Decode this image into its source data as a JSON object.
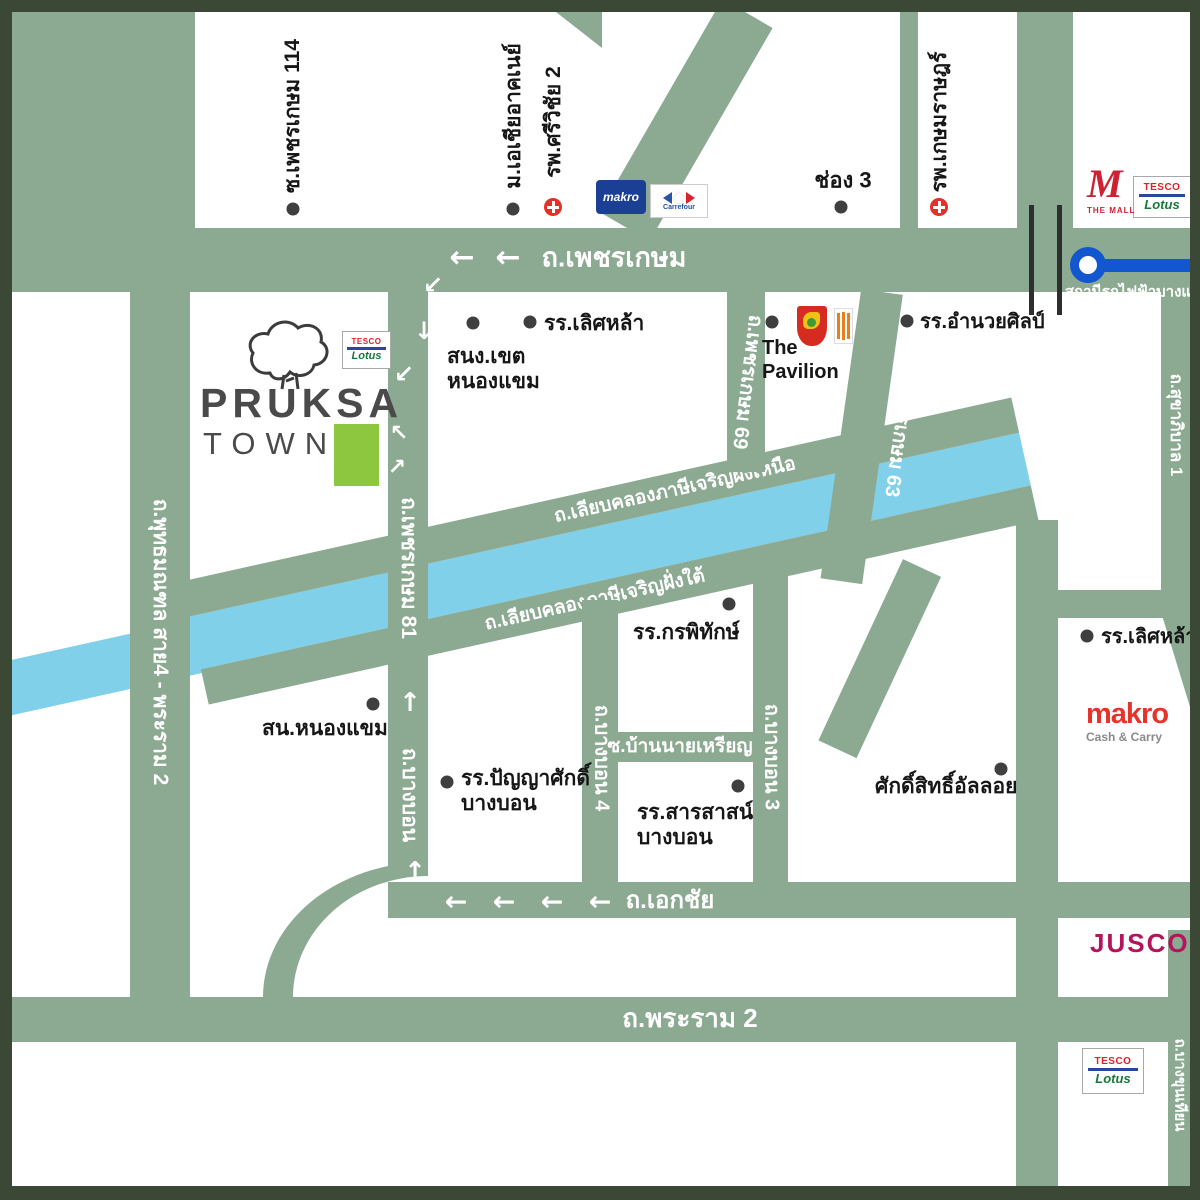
{
  "colors": {
    "road_green": "#8ca992",
    "canal_blue": "#7fd0e8",
    "frame_dark": "#3c4836",
    "pruksa_green": "#8dc63f",
    "bts_blue": "#1257cf"
  },
  "logo": {
    "name": "PRUKSA",
    "sub": "TOWN"
  },
  "roads": {
    "phetkasem": "ถ.เพชรเกษม",
    "phutthamonthon": "ถ.พุทธมณฑล สาย4 - พระราม 2",
    "phetkasem81": "ถ.เพชรเกษม 81",
    "bangbon": "ถ.บางบอน",
    "phetkasem69": "ถ.เพชรเกษม 69",
    "phetkasem63": "ถ.เพชรเกษม 63",
    "bangbon2": "ถ.บางบอน 2",
    "bangbon3": "ถ.บางบอน 3",
    "bangbon4": "ถ.บางบอน 4",
    "canal_north": "ถ.เลียบคลองภาษีเจริญฝั่งเหนือ",
    "canal_south": "ถ.เลียบคลองภาษีเจริญฝั่งใต้",
    "soi_ban_nai_rian": "ซ.บ้านนายเหรียญ",
    "ekachai": "ถ.เอกชัย",
    "rama2": "ถ.พระราม 2",
    "sukhaphiban1": "ถ.สุขาภิบาล 1",
    "bangkhunthian": "ถ.บางขุนเทียน"
  },
  "places": {
    "soi114": "ซ.เพชรเกษม 114",
    "sea_university": "ม.เอเชียอาคเนย์",
    "srivichai": "รพ.ศรีวิชัย 2",
    "channel3": "ช่อง 3",
    "kasemrad": "รพ.เกษมราษฎร์",
    "amnuaysilp": "รร.อำนวยศิลป์",
    "district_office_line1": "สนง.เขต",
    "district_office_line2": "หนองแขม",
    "lertlah": "รร.เลิศหล้า",
    "pavilion_line1": "The",
    "pavilion_line2": "Pavilion",
    "lertlah2": "รร.เลิศหล้า",
    "kornpitak": "รร.กรพิทักษ์",
    "police": "สน.หนองแขม",
    "panyasak_line1": "รร.ปัญญาศักดิ์",
    "panyasak_line2": "บางบอน",
    "sarasas_line1": "รร.สารสาสน์",
    "sarasas_line2": "บางบอน",
    "saksit": "ศักดิ์สิทธิ์อัลลอย"
  },
  "transit": {
    "station": "สถานีรถไฟฟ้าบางแค"
  },
  "brands": {
    "tesco": "TESCO",
    "lotus": "Lotus",
    "makro_top": "makro",
    "carrefour": "Carrefour",
    "mall_m": "M",
    "the_mall": "THE MALL",
    "makro": "makro",
    "makro_sub": "Cash & Carry",
    "jusco": "JUSCO"
  },
  "icons": {
    "arrow_left": "←",
    "arrow_up": "↑",
    "arrow_down": "↓",
    "arrow_down_left": "↙",
    "arrow_up_left": "↖",
    "arrow_up_right": "↗"
  }
}
